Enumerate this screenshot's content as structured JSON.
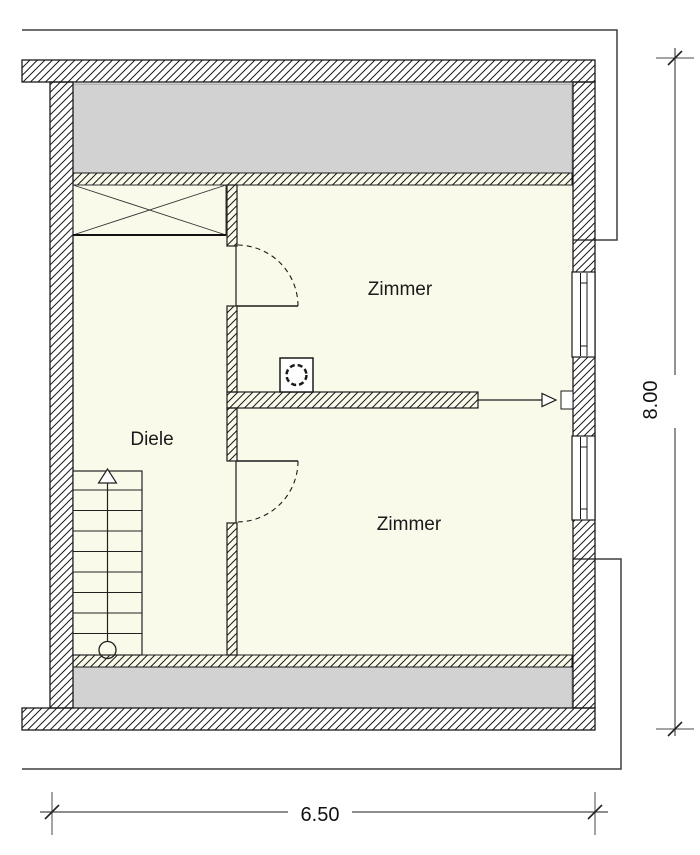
{
  "rooms": {
    "room_top": {
      "label": "Zimmer"
    },
    "hall": {
      "label": "Diele"
    },
    "room_bottom": {
      "label": "Zimmer"
    }
  },
  "dimensions": {
    "width_m": "6.50",
    "height_m": "8.00"
  },
  "symbols": {
    "stairs": "stair-run-with-up-arrow-and-start-circle",
    "wardrobe": "crossed-box",
    "vent": "dashed-circle-in-square-chimney",
    "doors": "quarter-circle-door-swing",
    "windows": "double-line-window-in-wall",
    "entrance": "open-arrow-through-wall-opening"
  },
  "colors": {
    "floor": "#fafaeb",
    "attic_area": "#d2d2d2",
    "wall_hatch": "#1a1a1a",
    "outline": "#3f3f3f",
    "text": "#1a1a1a"
  }
}
